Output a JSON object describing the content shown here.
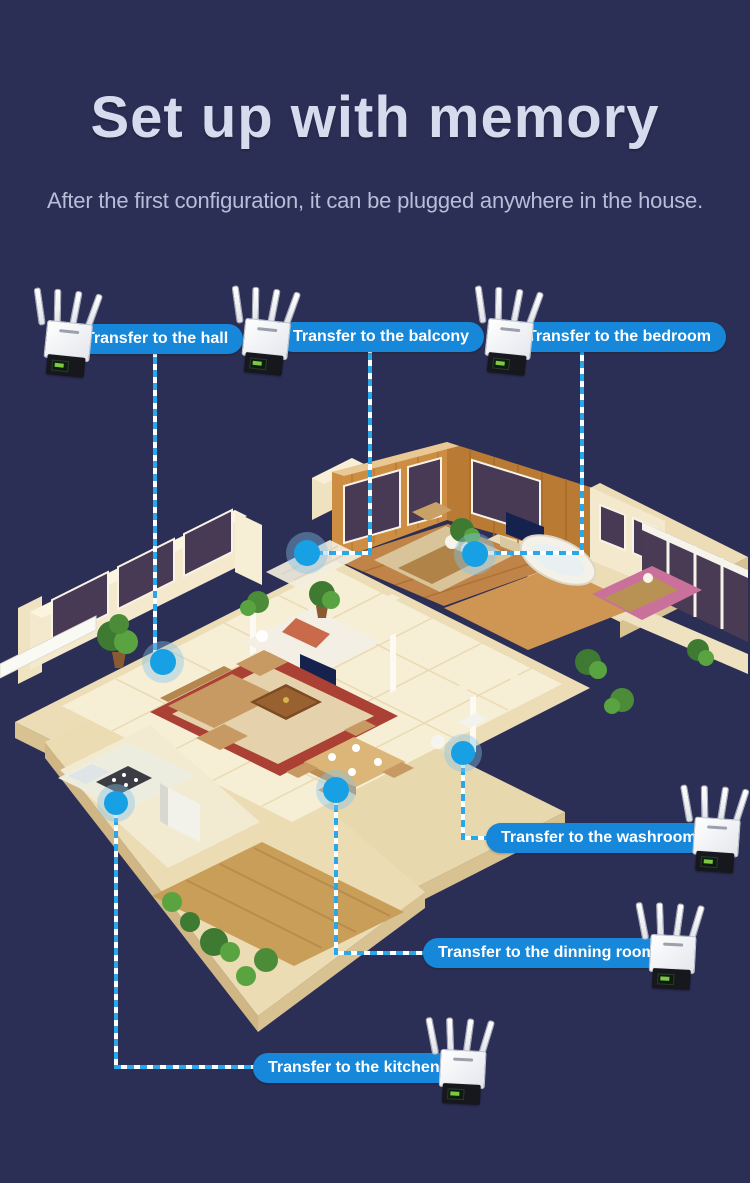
{
  "header": {
    "title": "Set up with memory",
    "subtitle": "After the first configuration, it can be plugged anywhere in the house."
  },
  "callouts": [
    {
      "id": "hall",
      "label": "Transfer to the hall"
    },
    {
      "id": "balcony",
      "label": "Transfer to the balcony"
    },
    {
      "id": "bedroom",
      "label": "Transfer to the bedroom"
    },
    {
      "id": "washroom",
      "label": "Transfer to the washroom"
    },
    {
      "id": "dinning-room",
      "label": "Transfer to the dinning room"
    },
    {
      "id": "kitchen",
      "label": "Transfer to the kitchen"
    }
  ],
  "device_count": 6,
  "icons": {
    "device": "wifi-repeater",
    "marker": "location-dot"
  },
  "colors": {
    "background": "#2c2f55",
    "title_text": "#d6dcee",
    "subtitle_text": "#b7bed8",
    "callout_pill": "#1787d9",
    "callout_text": "#ffffff",
    "connector_line": "#2aa7e8",
    "location_dot": "#18a0e4"
  }
}
